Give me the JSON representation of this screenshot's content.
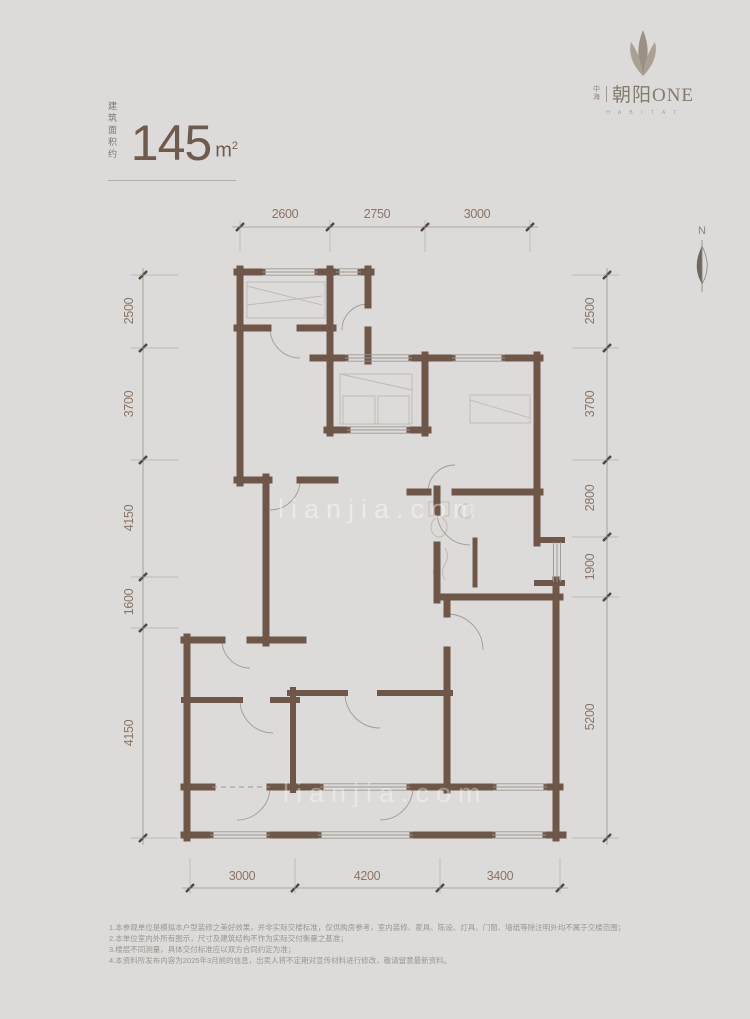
{
  "logo": {
    "brand_small_top": "中",
    "brand_small_bottom": "海",
    "brand": "朝阳ONE",
    "sub": "H A B I T A T"
  },
  "area": {
    "label_line1": "建 筑",
    "label_line2": "面积约",
    "value": "145",
    "unit_base": "m",
    "unit_sup": "2"
  },
  "compass": {
    "label": "N"
  },
  "watermark": {
    "text_upper": "lianjia.com",
    "text_lower": "lianjia.com"
  },
  "dims": {
    "top": [
      "2600",
      "2750",
      "3000"
    ],
    "bottom": [
      "3000",
      "4200",
      "3400"
    ],
    "left": [
      "2500",
      "3700",
      "4150",
      "1600",
      "4150"
    ],
    "right": [
      "2500",
      "3700",
      "2800",
      "1900",
      "5200"
    ]
  },
  "disclaimer": {
    "lines": [
      "1.本参观单位是模拟本户型装修之美好效果，并非实际交楼标准，仅供购房参考，室内装修、家具、陈设、灯具、门窗、墙纸等除注明外均不属于交楼范围；",
      "2.本单位室内外所有图示，尺寸及建筑结构不作为实际交付衡量之基准；",
      "3.楼层不同测量，具体交付标准应以双方合同约定为准；",
      "4.本资料所发布内容为2025年3月前的信息，出卖人将不定期对宣传材料进行修改，敬请留意最新资料。"
    ]
  },
  "colors": {
    "background": "#dcdbd9",
    "wall": "#6E5748",
    "dim_text": "#8A7466",
    "accent_text": "#6F5B4D",
    "sketch_line": "#bdb8b1"
  }
}
